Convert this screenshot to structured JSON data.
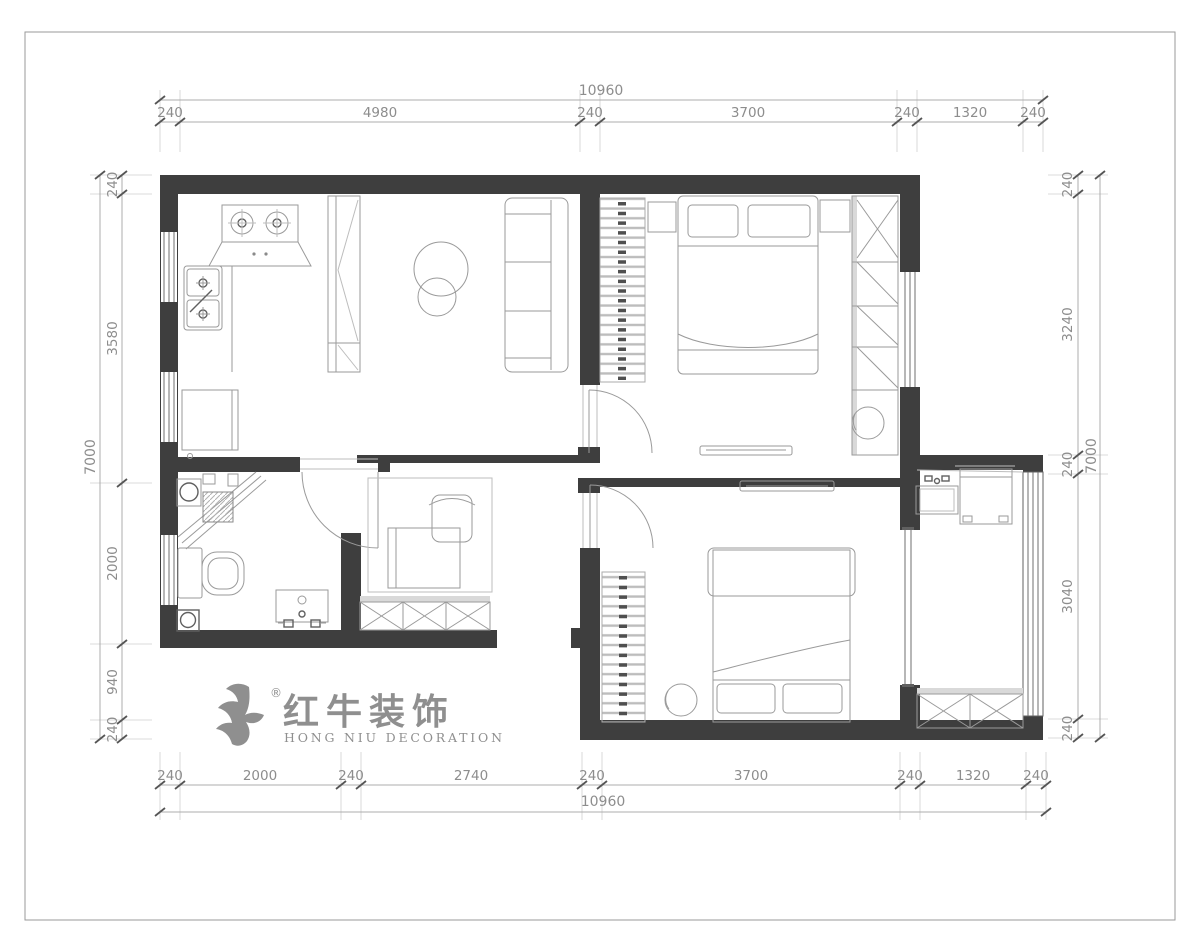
{
  "dimensions": {
    "top": {
      "total": "10960",
      "segments": [
        "240",
        "4980",
        "240",
        "3700",
        "240",
        "1320",
        "240"
      ]
    },
    "bottom": {
      "total": "10960",
      "segments": [
        "240",
        "2000",
        "240",
        "2740",
        "240",
        "3700",
        "240",
        "1320",
        "240"
      ]
    },
    "left": {
      "total": "7000",
      "segments": [
        "240",
        "3580",
        "2000",
        "940",
        "240"
      ]
    },
    "right": {
      "total": "7000",
      "segments": [
        "240",
        "3240",
        "240",
        "3040",
        "240"
      ]
    }
  },
  "logo": {
    "registered": "®",
    "name_cn": "红牛装饰",
    "name_en": "HONG NIU DECORATION"
  },
  "colors": {
    "wall": "#3e3e3e",
    "furniture_line": "#9a9a9a",
    "dimension_text": "#8d8d8d",
    "logo_gray": "#8f8f8f"
  }
}
